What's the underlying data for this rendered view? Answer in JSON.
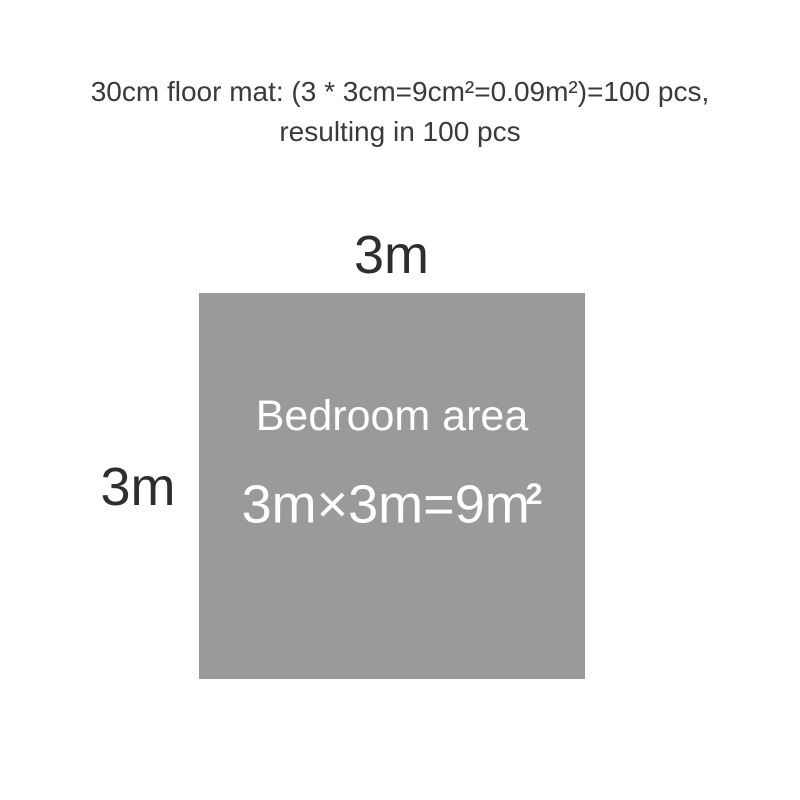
{
  "title": {
    "line1": "30cm floor mat: (3 * 3cm=9cm²=0.09m²)=100 pcs,",
    "line2": "resulting in 100 pcs"
  },
  "diagram": {
    "top_dimension_label": "3m",
    "left_dimension_label": "3m",
    "square_fill_color": "#9a9a9a",
    "area_label": "Bedroom area",
    "formula_base": "3m×3m=9m",
    "formula_superscript": "2"
  }
}
